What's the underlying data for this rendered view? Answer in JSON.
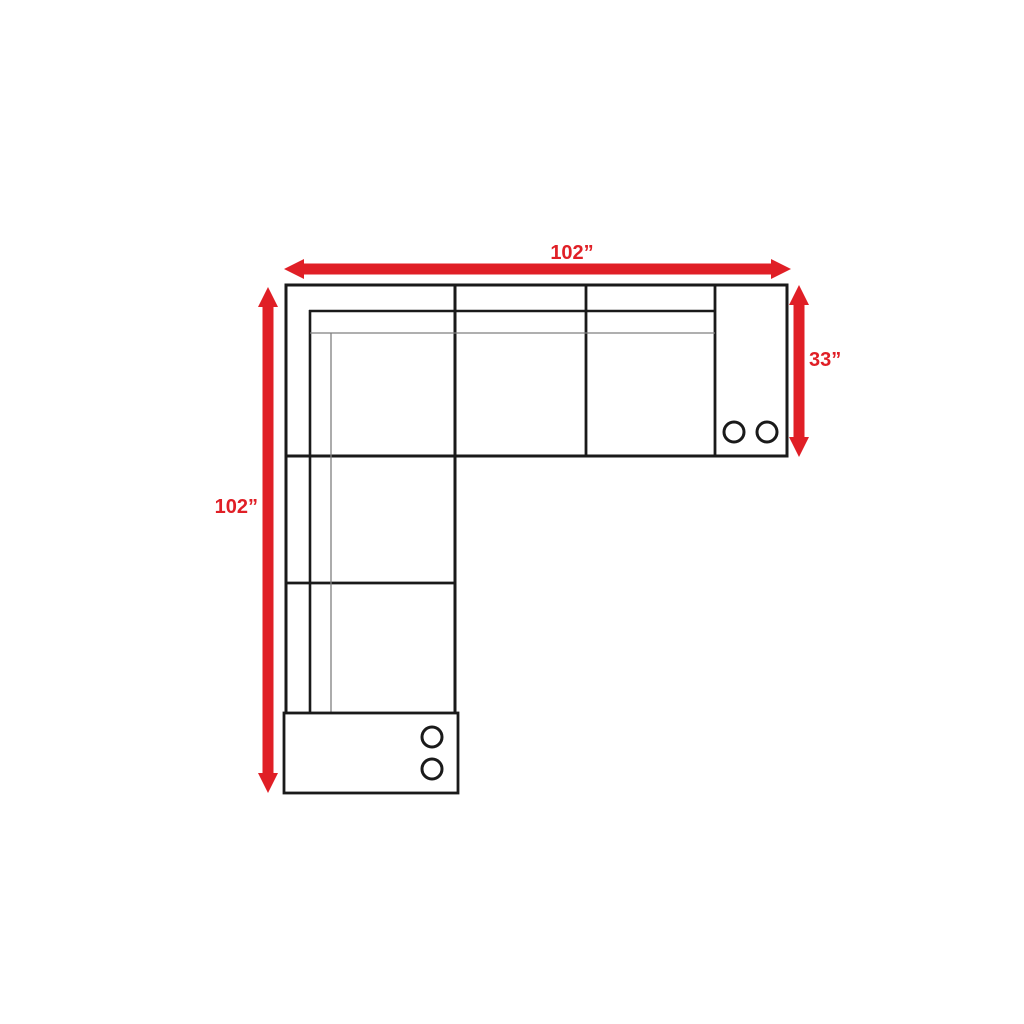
{
  "diagram": {
    "type": "sectional-sofa-floorplan",
    "labels": {
      "top": "102”",
      "left": "102”",
      "right": "33”"
    },
    "values": {
      "top_inches": 102,
      "left_inches": 102,
      "right_inches": 33
    },
    "cupholders": {
      "right_armrest": 2,
      "bottom_armrest": 2
    }
  },
  "colors": {
    "accent": "#e01f26",
    "line": "#1a1a1a",
    "thin": "#7f7f7f",
    "bg": "#ffffff"
  }
}
